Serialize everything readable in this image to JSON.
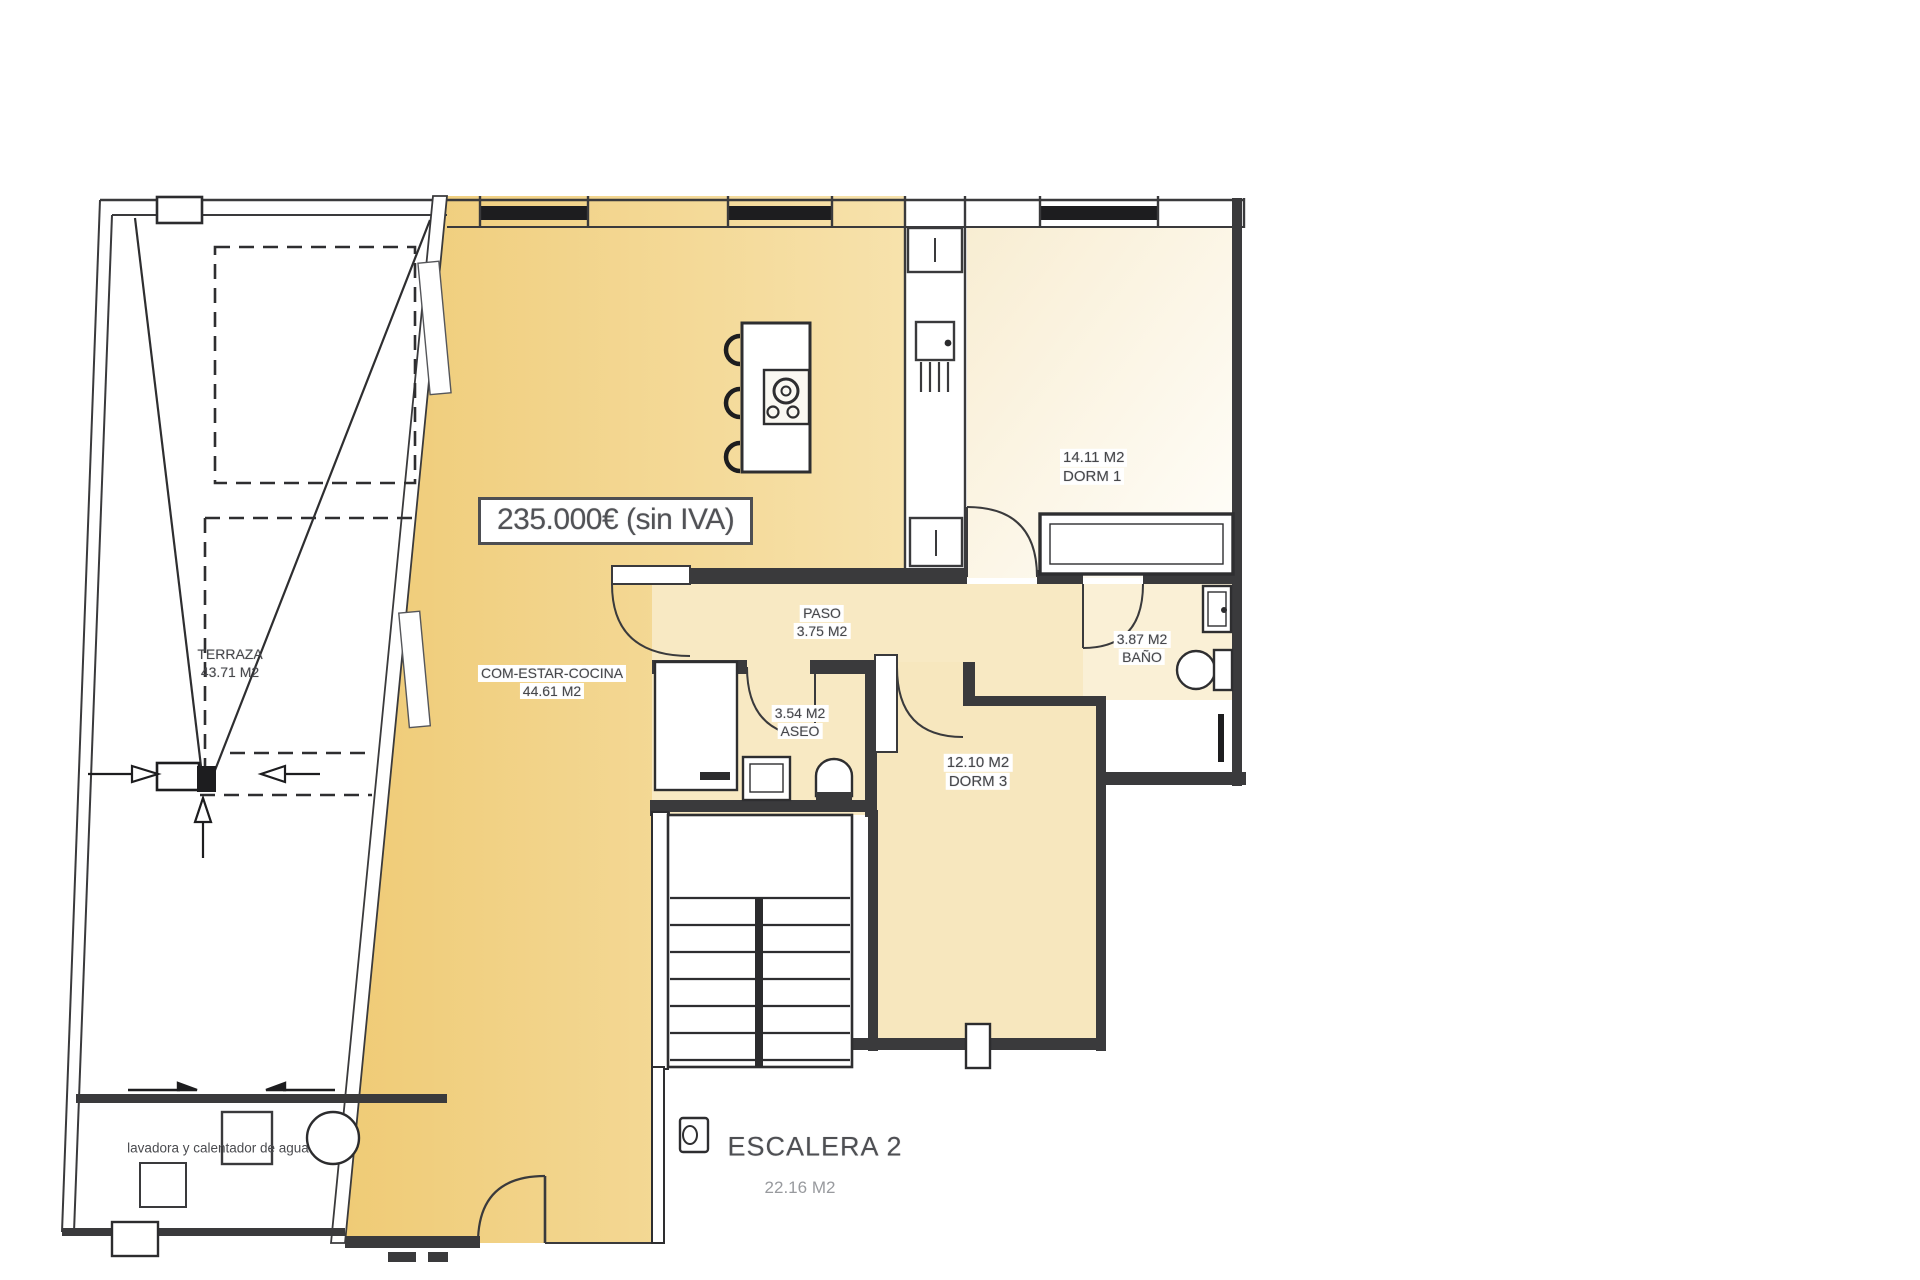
{
  "plan": {
    "title": "floor plan",
    "price_label": "235.000€ (sin IVA)",
    "rooms": {
      "terraza": {
        "name": "TERRAZA",
        "area": "43.71 M2"
      },
      "com_estar": {
        "name": "COM-ESTAR-COCINA",
        "area": "44.61 M2"
      },
      "paso": {
        "name": "PASO",
        "area": "3.75 M2"
      },
      "aseo": {
        "name": "ASEO",
        "area": "3.54 M2"
      },
      "dorm1": {
        "name": "DORM 1",
        "area": "14.11 M2"
      },
      "bano": {
        "name": "BAÑO",
        "area": "3.87 M2"
      },
      "dorm3": {
        "name": "DORM 3",
        "area": "12.10 M2"
      },
      "escalera": {
        "name": "ESCALERA 2",
        "area": "22.16 M2"
      }
    },
    "notes": {
      "utility": "lavadora y calentador de agua"
    },
    "colors": {
      "kitchen_fill": "#F2D287",
      "light_room_fill": "#F8E9C3",
      "dorm1_fill": "#FAF2DE",
      "wall": "#3A3A3C",
      "window_bar": "#1D1D1F"
    }
  }
}
